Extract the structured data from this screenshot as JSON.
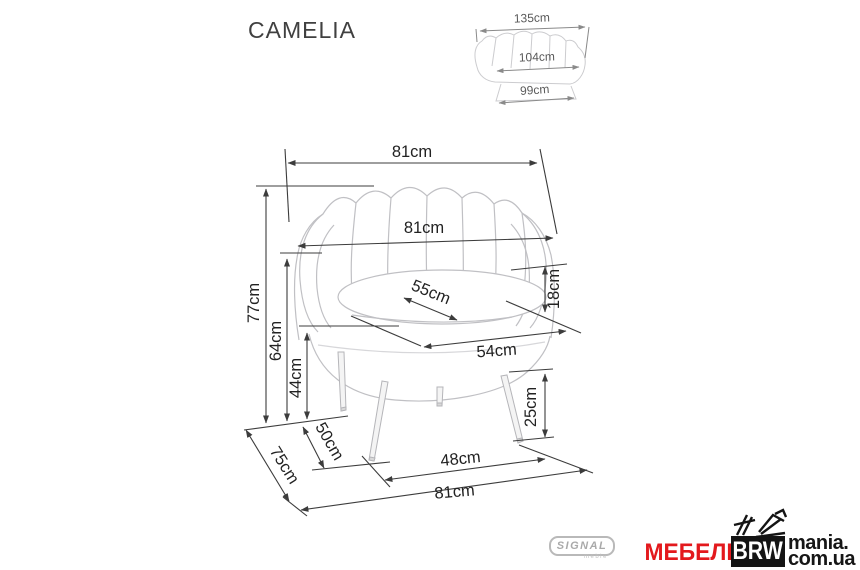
{
  "title": "CAMELIA",
  "main_view": {
    "dims": {
      "top_width": "81cm",
      "back_width": "81cm",
      "height": "77cm",
      "back_side_height": "64cm",
      "arm_height": "44cm",
      "seat_depth": "55cm",
      "cushion_thickness": "18cm",
      "seat_width": "54cm",
      "leg_height": "25cm",
      "front_leg_span": "48cm",
      "base_depth": "50cm",
      "overall_depth": "75cm",
      "bottom_width": "81cm"
    }
  },
  "inset_view": {
    "dims": {
      "top_width": "135cm",
      "seat_width": "104cm",
      "base_width": "99cm"
    }
  },
  "branding": {
    "signal": {
      "label": "SIGNAL",
      "sub": "meble"
    },
    "watermark": {
      "mebel": "МЕБЕЛЬ",
      "brw": "BRW",
      "line1": "mania.",
      "line2": "com.ua"
    }
  },
  "colors": {
    "dimension_line": "#3c3c3c",
    "chair_outline": "#c0c0c4",
    "inset_line": "#8a8a8a",
    "watermark_red": "#e3191d",
    "watermark_black": "#141414",
    "signal_gray": "#a9a9a9"
  }
}
